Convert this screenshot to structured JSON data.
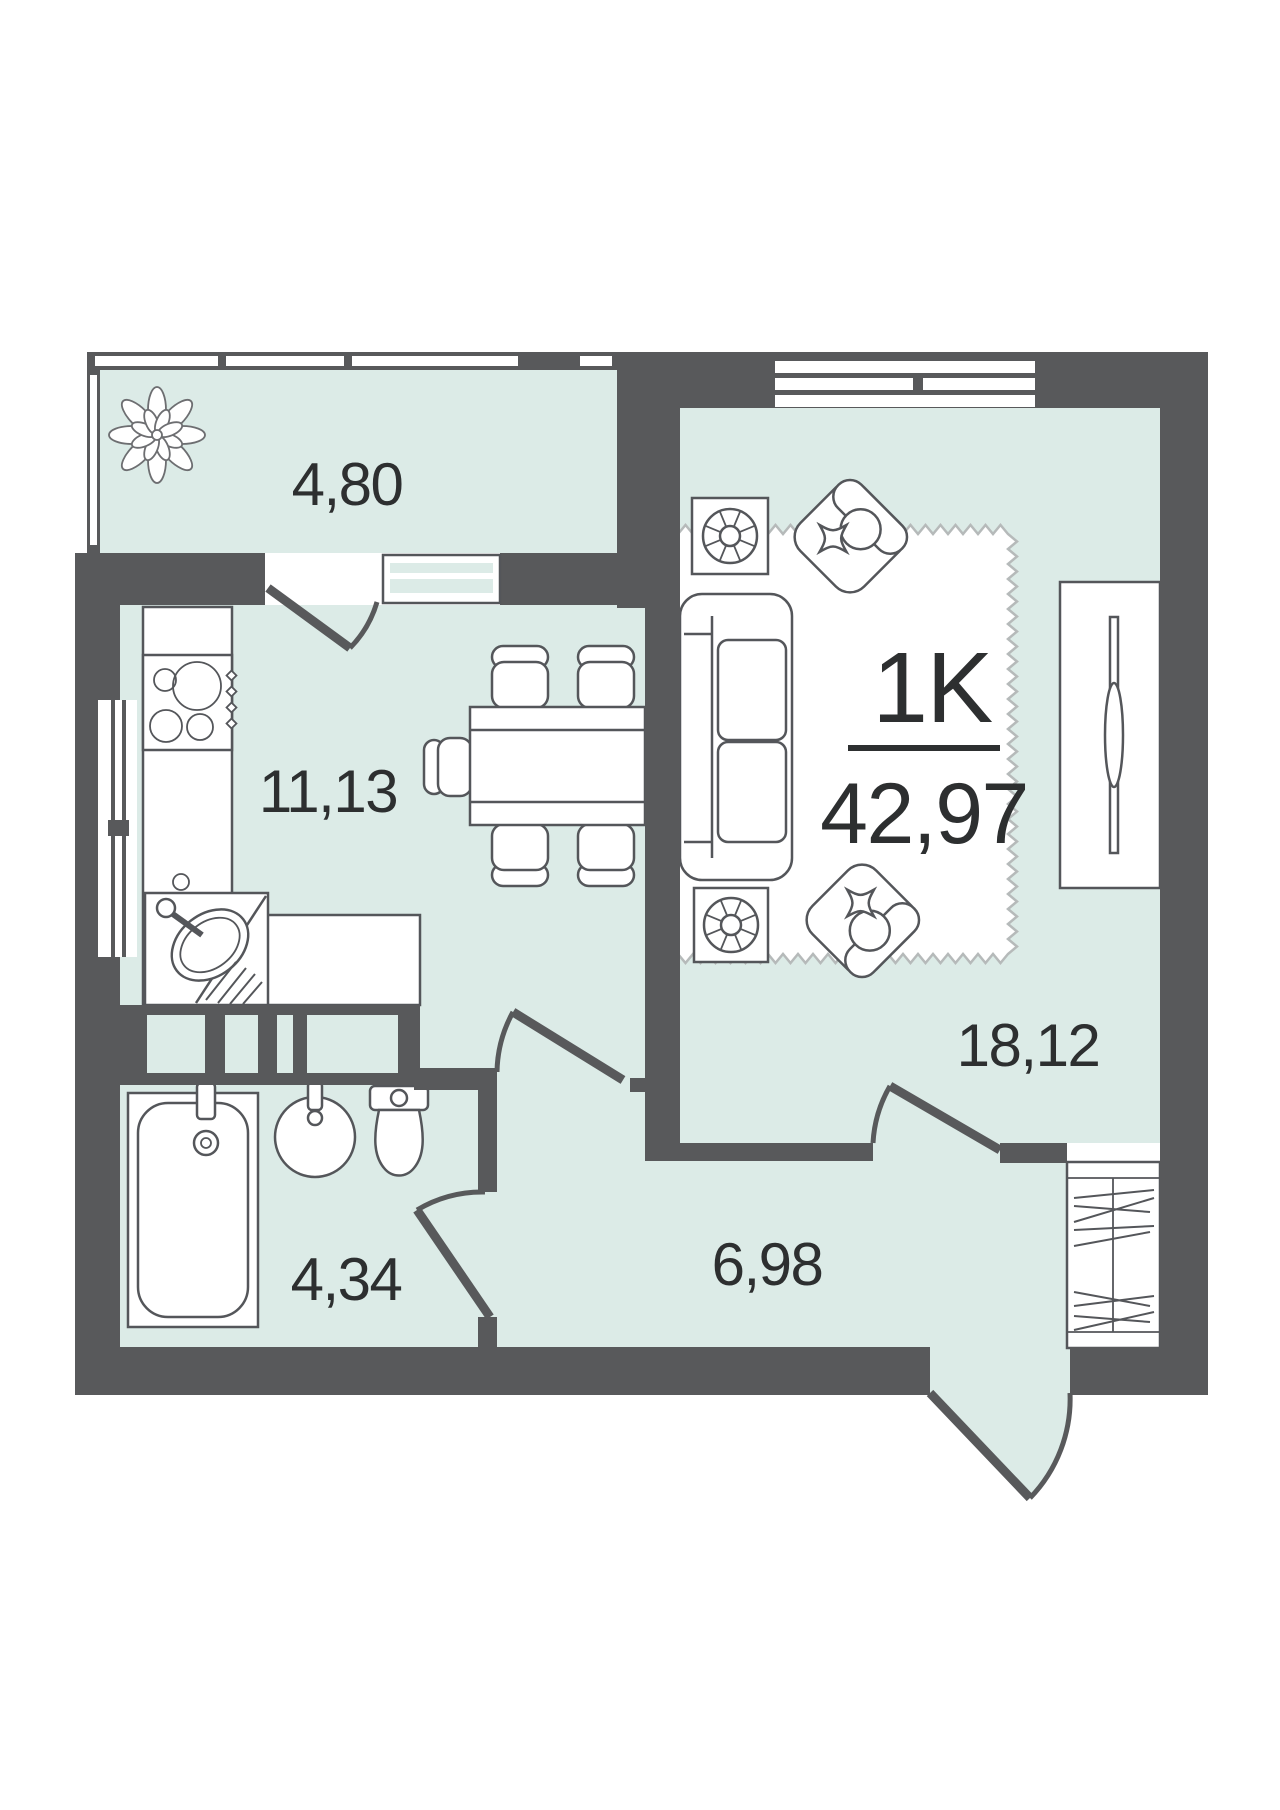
{
  "apartment": {
    "type_label": "1K",
    "total_area": "42,97"
  },
  "rooms": [
    {
      "id": "balcony",
      "area": "4,80"
    },
    {
      "id": "kitchen",
      "area": "11,13"
    },
    {
      "id": "living-room",
      "area": "18,12"
    },
    {
      "id": "hallway",
      "area": "6,98"
    },
    {
      "id": "bathroom",
      "area": "4,34"
    }
  ],
  "icons": [
    "plant-icon",
    "stove-icon",
    "kitchen-sink-icon",
    "dining-table",
    "chair",
    "sofa",
    "armchair",
    "side-table-icon",
    "wardrobe",
    "rug",
    "bathtub-icon",
    "washbasin-icon",
    "toilet-icon",
    "shoe-cabinet",
    "window",
    "door-swing"
  ],
  "colors": {
    "wall": "#58595b",
    "floor": "#dcebe7",
    "furniture_line": "#54565a",
    "rug_line": "#b6baba",
    "text": "#2d2f30"
  }
}
